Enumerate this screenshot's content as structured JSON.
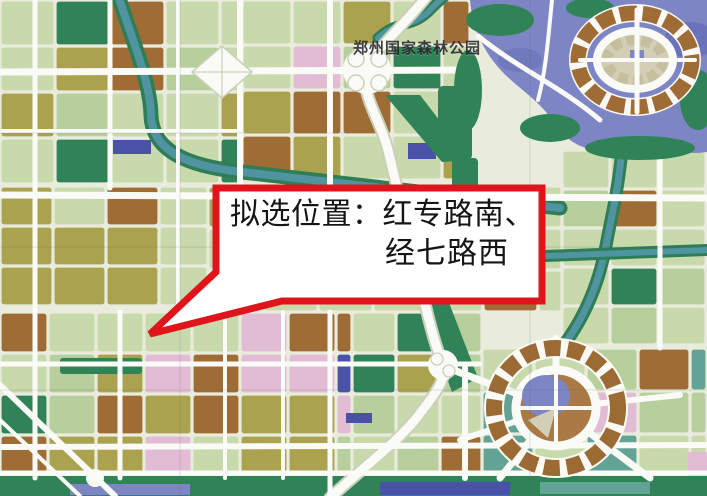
{
  "map": {
    "forest_park_label": "郑州国家森林公园"
  },
  "callout": {
    "line1": "拟选位置：红专路南、",
    "line2": "经七路西"
  },
  "palette": {
    "base": "#e9ecdc",
    "road": "#fafbf7",
    "casing": "#c9d1ba",
    "lg": "#c8d9ac",
    "lg2": "#b7cf9c",
    "ol": "#aba24f",
    "br": "#a06c36",
    "br2": "#9c6a33",
    "pk": "#e2bcd4",
    "dg": "#2f8357",
    "bl": "#4a51a8",
    "lav": "#a3aad6",
    "teal": "#63a396",
    "tan": "#d2cfb6",
    "lake": "#7d85c4",
    "lakeDark": "#6a73ba",
    "riverTeal": "#4f94a0",
    "riverGreen": "#2e7d55",
    "red": "#e0151c",
    "white": "#ffffff",
    "ink": "#151515",
    "label": "#26262b"
  }
}
